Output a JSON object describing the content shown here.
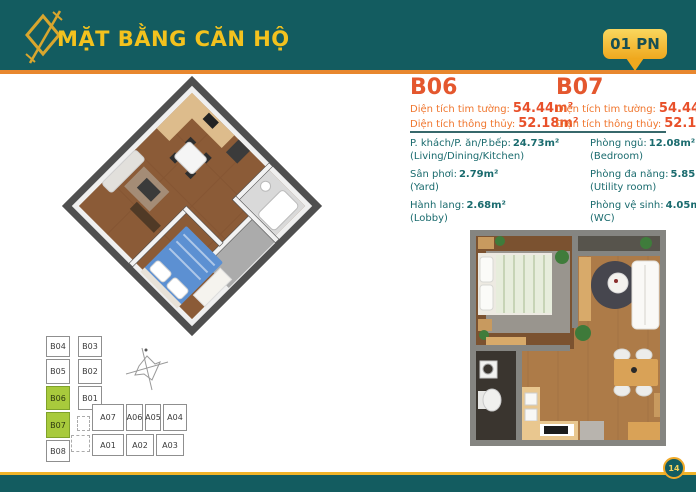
{
  "colors": {
    "teal": "#135C60",
    "gold": "#F2B52B",
    "orange_accent": "#E8872E",
    "heading_orange": "#E4572E",
    "label_orange": "#F0762E",
    "detail_teal": "#1A6B6E",
    "highlight_green": "#A8CA3C"
  },
  "header": {
    "title": "MẶT BẰNG CĂN HỘ",
    "badge_label": "01 PN"
  },
  "units": [
    {
      "name": "B06",
      "metrics": [
        {
          "label": "Diện tích tim tường:",
          "value": "54.44m²"
        },
        {
          "label": "Diện tích thông thủy:",
          "value": "52.18m²"
        }
      ],
      "rooms": [
        {
          "vi": "P. khách/P. ăn/P.bếp:",
          "value": "24.73m²",
          "en": "(Living/Dining/Kitchen)"
        },
        {
          "vi": "Sân phơi:",
          "value": "2.79m²",
          "en": "(Yard)"
        },
        {
          "vi": "Hành lang:",
          "value": "2.68m²",
          "en": "(Lobby)"
        }
      ]
    },
    {
      "name": "B07",
      "metrics": [
        {
          "label": "Diện tích tim tường:",
          "value": "54.44m²"
        },
        {
          "label": "Diện tích thông thủy:",
          "value": "52.18m²"
        }
      ],
      "rooms": [
        {
          "vi": "Phòng ngủ:",
          "value": "12.08m²",
          "en": "(Bedroom)"
        },
        {
          "vi": "Phòng đa năng:",
          "value": "5.85m²",
          "en": "(Utility room)"
        },
        {
          "vi": "Phòng vệ sinh:",
          "value": "4.05m²",
          "en": "(WC)"
        }
      ]
    }
  ],
  "keyplan": {
    "highlighted": [
      "B06",
      "B07"
    ],
    "cells": [
      {
        "label": "B04"
      },
      {
        "label": "B03"
      },
      {
        "label": "B05"
      },
      {
        "label": "B02"
      },
      {
        "label": "B06"
      },
      {
        "label": "B01"
      },
      {
        "label": "B07"
      },
      {
        "label": "B08"
      },
      {
        "label": "A07"
      },
      {
        "label": "A06"
      },
      {
        "label": "A05"
      },
      {
        "label": "A04"
      },
      {
        "label": "A01"
      },
      {
        "label": "A02"
      },
      {
        "label": "A03"
      }
    ]
  },
  "footer": {
    "page_number": "14"
  }
}
